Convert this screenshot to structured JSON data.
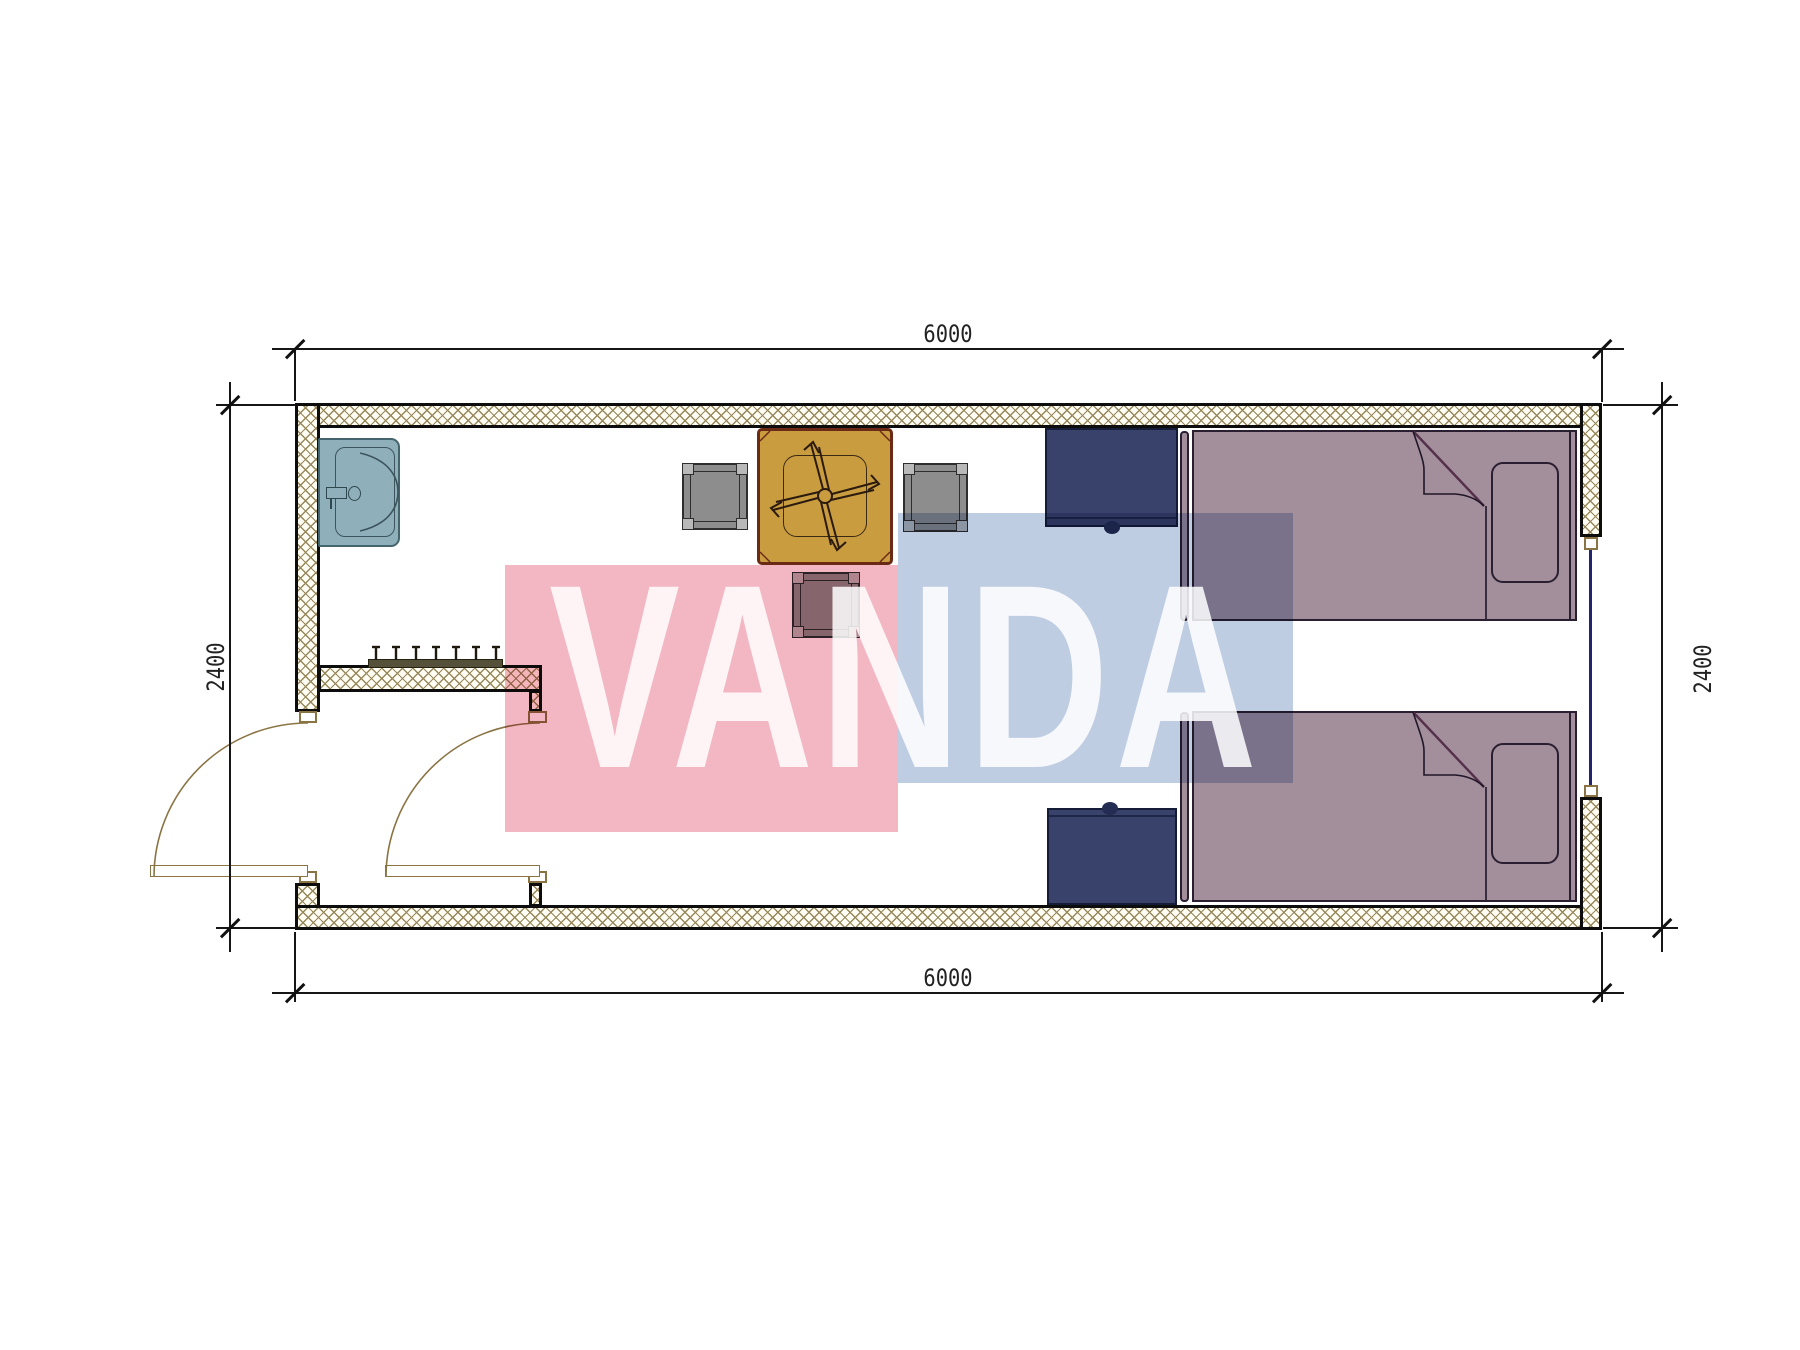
{
  "diagram": {
    "type": "architectural-floor-plan",
    "units": "mm",
    "dimensions": {
      "top": "6000",
      "bottom": "6000",
      "left": "2400",
      "right": "2400"
    },
    "watermark": {
      "text": "VANDA",
      "pink_color": "#f3b7c3",
      "blue_color": "#bfcde2",
      "text_color": "rgba(255,255,255,0.85)"
    },
    "colors": {
      "wall_outline": "#0d0d0d",
      "wall_hatch": "#97875a",
      "door_symbol": "#8a7444",
      "window_glazing": "#24246e",
      "sink_fill": "#8fb0ba",
      "sink_outline": "#44656e",
      "table_fill": "#c99c40",
      "table_border": "#6b2a16",
      "chair_fill": "#8d8d8d",
      "chair_outline": "#2e2e2e",
      "nightstand_fill": "#39426a",
      "bed_fill": "#a38e9c",
      "bed_outline": "#2a1f30",
      "coat_rack": "#55503a",
      "dimension_lines": "#161616"
    },
    "symbols": [
      "sink",
      "coat-rack",
      "dining-table",
      "ceiling-fan",
      "chair",
      "stool",
      "nightstand",
      "single-bed",
      "pillow",
      "entry-door",
      "window"
    ]
  }
}
